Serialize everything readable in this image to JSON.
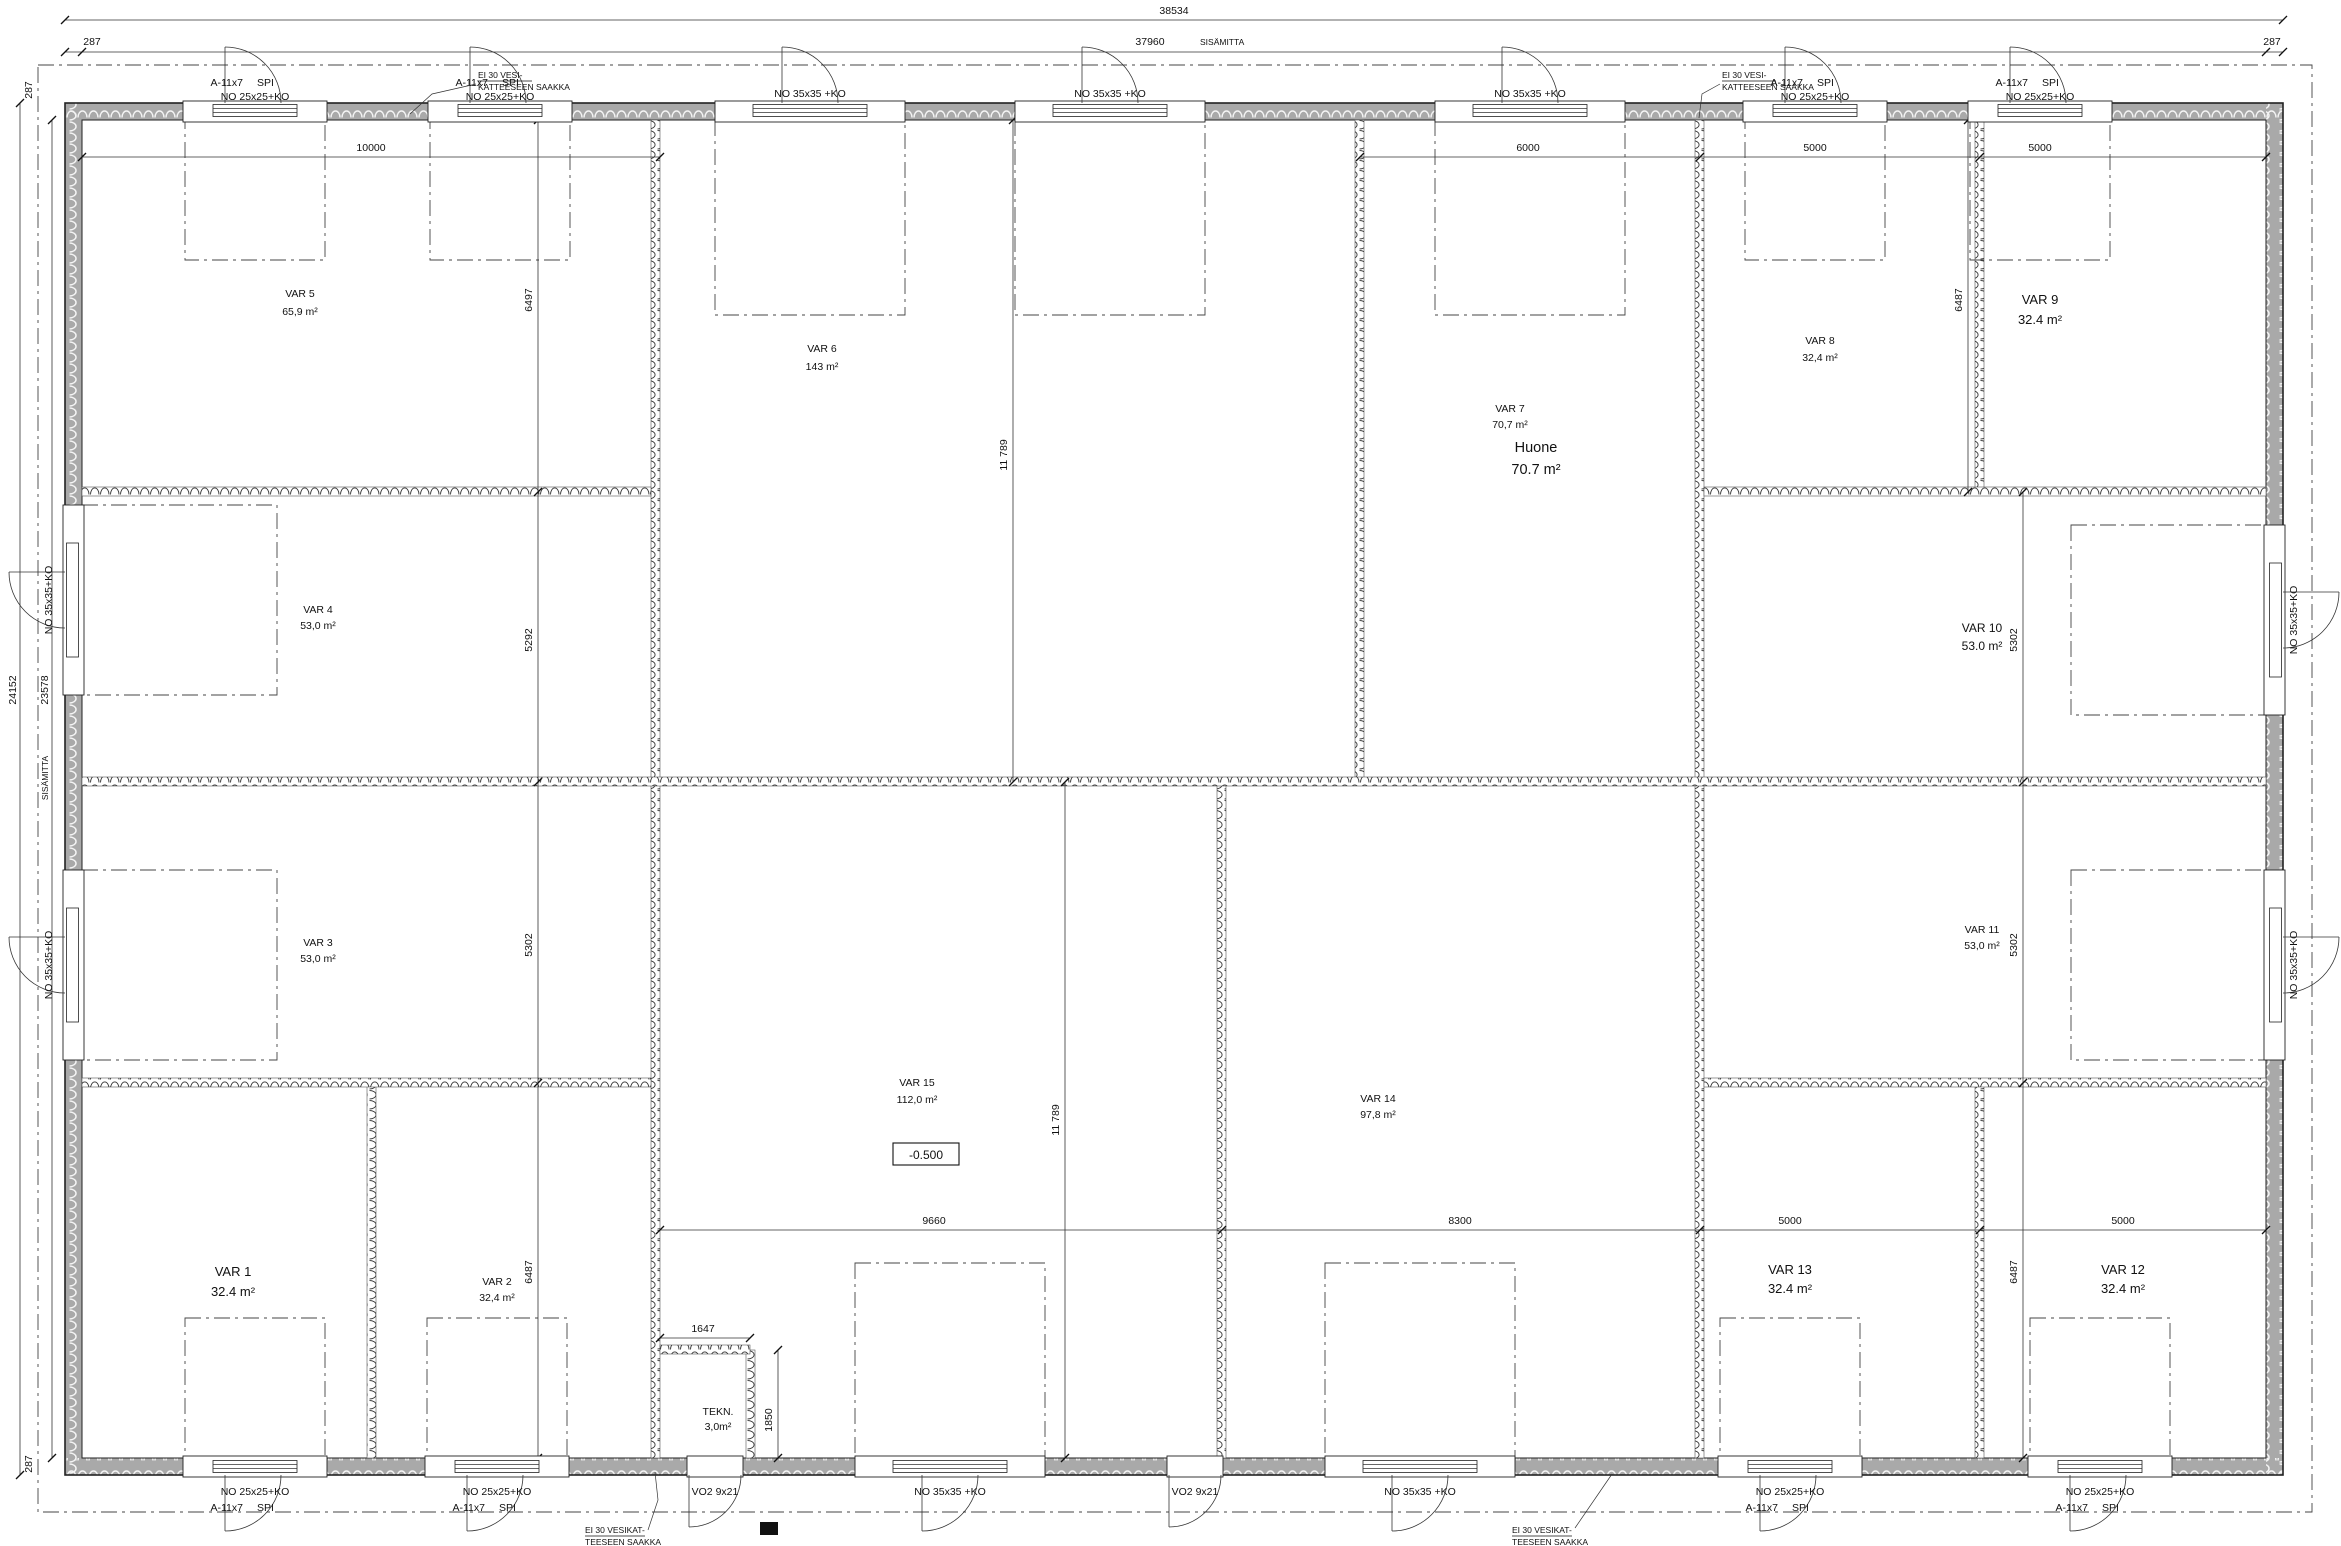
{
  "dims": {
    "total_width": "38534",
    "inner_width": "37960",
    "sisamitta": "SISÄMITTA",
    "wall": "287",
    "total_height": "24152",
    "inner_height": "23578",
    "w10000": "10000",
    "w6000": "6000",
    "w5000": "5000",
    "w9660": "9660",
    "w8300": "8300",
    "h6497": "6497",
    "h5292": "5292",
    "h5302": "5302",
    "h6487": "6487",
    "h11789": "11 789",
    "tek_w": "1647",
    "tek_h": "1850"
  },
  "doors": {
    "no25": "NO 25x25+KO",
    "no35": "NO 35x35 +KO",
    "no35v": "NO 35x35+KO",
    "a11": "A-11x7",
    "spi": "SPI",
    "vo2": "VO2 9x21"
  },
  "notes": {
    "top1": "EI 30 VESI-",
    "top2": "KATTEESEEN SAAKKA",
    "bottom1": "EI 30 VESIKAT-",
    "bottom2": "TEESEEN SAAKKA"
  },
  "elevation": "-0.500",
  "rooms": [
    {
      "name": "VAR 1",
      "area": "32.4 m²"
    },
    {
      "name": "VAR 2",
      "area": "32,4 m²"
    },
    {
      "name": "VAR 3",
      "area": "53,0 m²"
    },
    {
      "name": "VAR 4",
      "area": "53,0 m²"
    },
    {
      "name": "VAR 5",
      "area": "65,9 m²"
    },
    {
      "name": "VAR 6",
      "area": "143 m²"
    },
    {
      "name": "VAR 7",
      "area": "70,7 m²",
      "sub_name": "Huone",
      "sub_area": "70.7 m²"
    },
    {
      "name": "VAR 8",
      "area": "32,4 m²"
    },
    {
      "name": "VAR 9",
      "area": "32.4 m²"
    },
    {
      "name": "VAR 10",
      "area": "53.0 m²"
    },
    {
      "name": "VAR 11",
      "area": "53,0 m²"
    },
    {
      "name": "VAR 12",
      "area": "32.4 m²"
    },
    {
      "name": "VAR 13",
      "area": "32.4 m²"
    },
    {
      "name": "VAR 14",
      "area": "97,8 m²"
    },
    {
      "name": "VAR 15",
      "area": "112,0 m²"
    },
    {
      "name": "TEKN.",
      "area": "3,0m²"
    }
  ]
}
